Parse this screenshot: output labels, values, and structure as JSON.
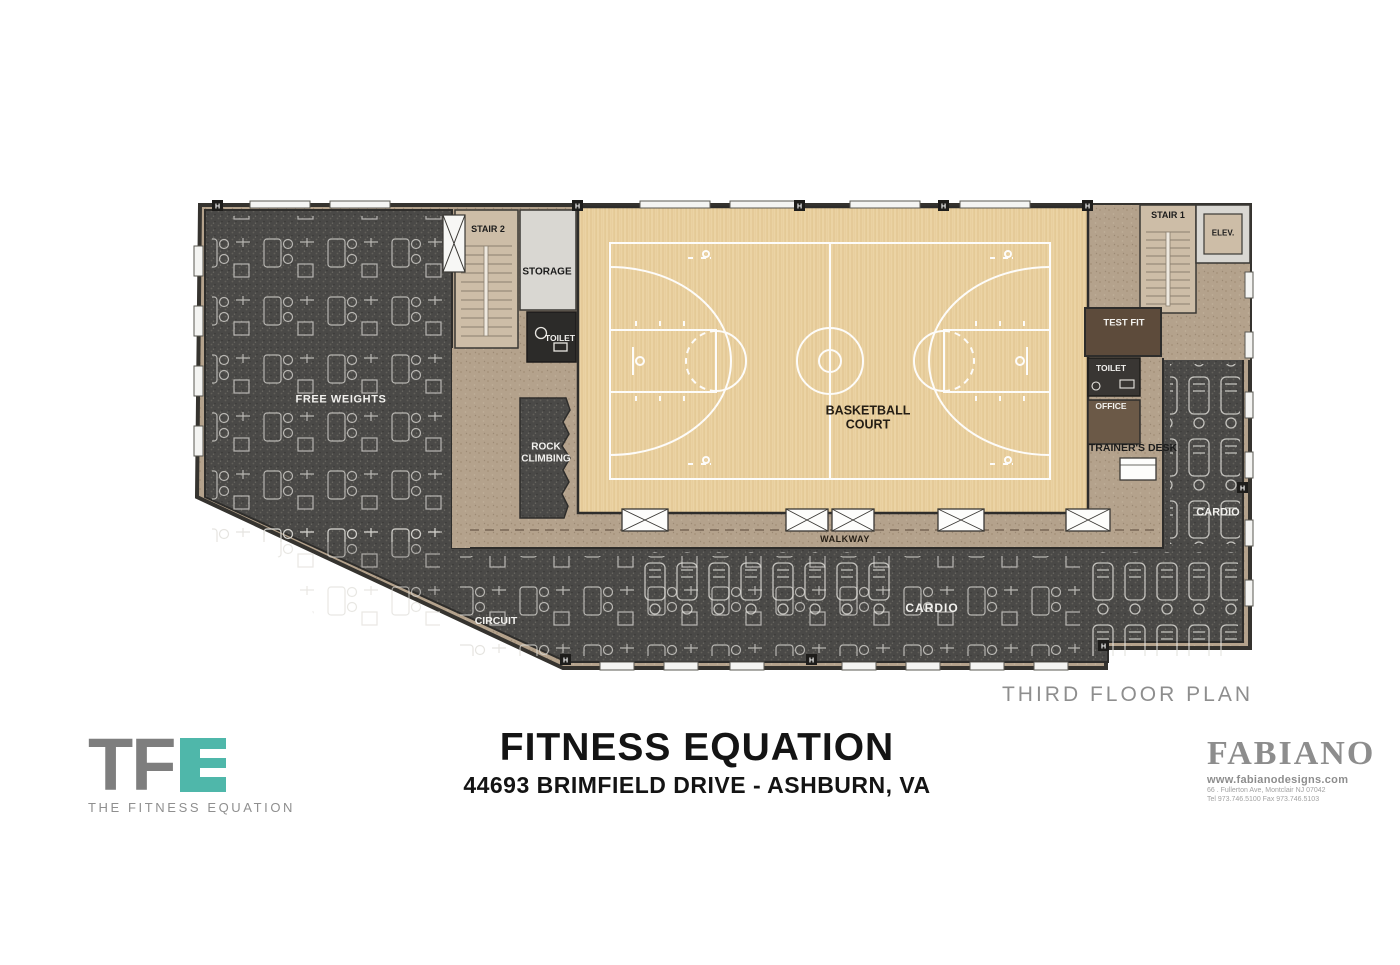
{
  "plan": {
    "caption": "THIRD FLOOR PLAN",
    "column_marker": "H",
    "rooms": {
      "stair2": "STAIR 2",
      "storage": "STORAGE",
      "toilet_left": "TOILET",
      "free_weights": "FREE WEIGHTS",
      "rock_climbing_line1": "ROCK",
      "rock_climbing_line2": "CLIMBING",
      "basketball_line1": "BASKETBALL",
      "basketball_line2": "COURT",
      "walkway": "WALKWAY",
      "circuit": "CIRCUIT",
      "cardio": "CARDIO",
      "cardio_right": "CARDIO",
      "stair1": "STAIR 1",
      "elevator": "ELEV.",
      "test_fit": "TEST FIT",
      "toilet_right": "TOILET",
      "office": "OFFICE",
      "trainers_desk": "TRAINER'S DESK"
    }
  },
  "titleblock": {
    "title": "FITNESS EQUATION",
    "subtitle": "44693 BRIMFIELD DRIVE - ASHBURN, VA"
  },
  "tfe_logo": {
    "letter_t": "T",
    "letter_f": "F",
    "caption": "THE FITNESS EQUATION"
  },
  "fabiano": {
    "name": "FABIANO",
    "website": "www.fabianodesigns.com",
    "address": "66 . Fullerton Ave, Montclair NJ 07042",
    "phone": "Tel 973.746.5100   Fax 973.746.5103"
  },
  "colors": {
    "accent_teal": "#4fb7aa",
    "carpet_dark": "#4a4947",
    "court_wood": "#ebd3a4",
    "floor_tan": "#b4a28c",
    "caption_gray": "#8e8e8e"
  }
}
